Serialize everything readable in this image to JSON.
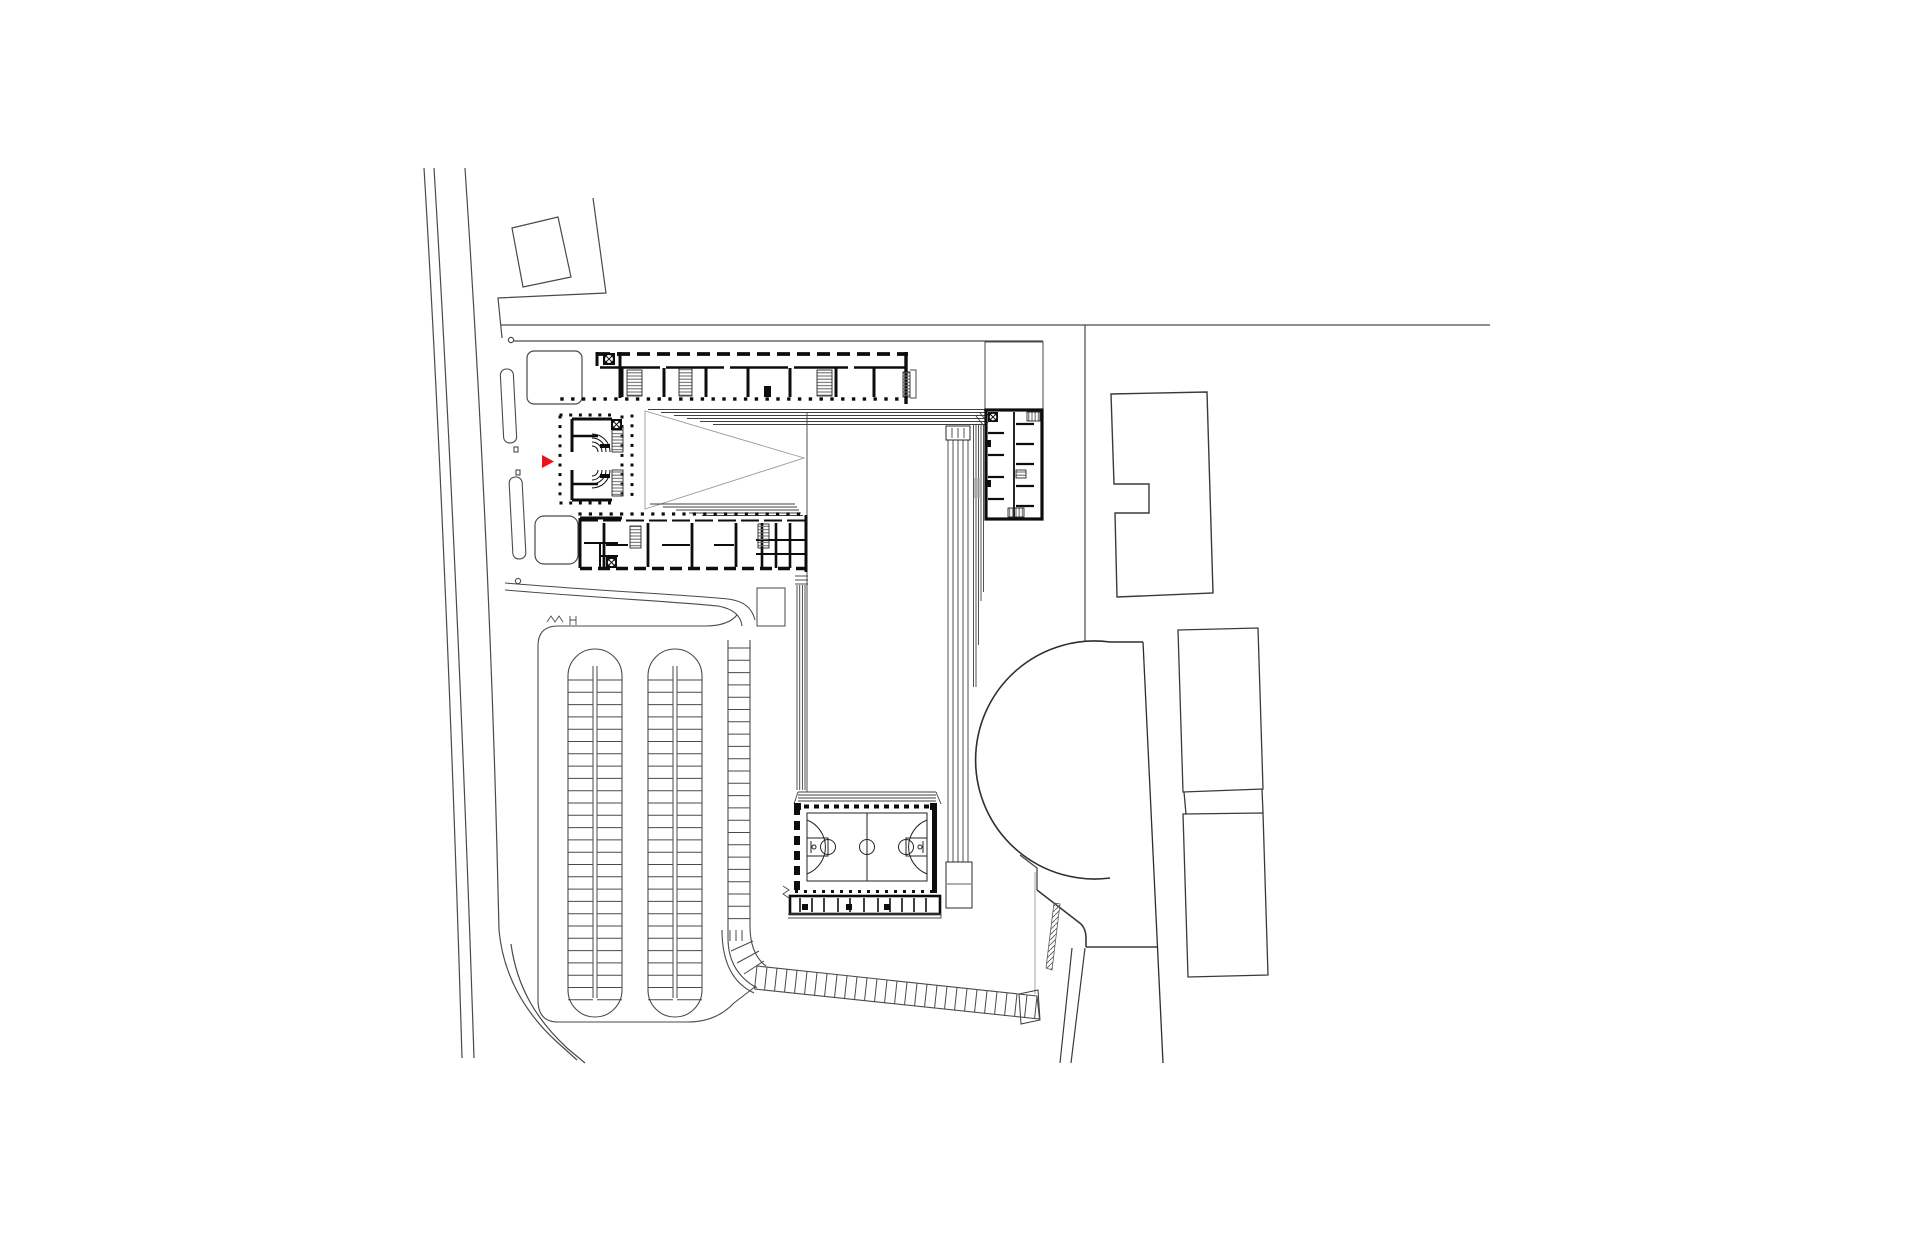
{
  "meta": {
    "kind": "architectural-site-plan",
    "canvas": {
      "width": 1920,
      "height": 1260,
      "background": "#ffffff"
    }
  },
  "colors": {
    "ink": "#0d0d0d",
    "site": "#4a4a4a",
    "roof": "#3f3f3f",
    "light": "#9a9a9a",
    "hatch": "#6f6f6f",
    "red": "#e8131b",
    "grey_fill": "#a8a8a8"
  },
  "marker": {
    "shape": "triangle-right",
    "points": [
      [
        542,
        455
      ],
      [
        542,
        468
      ],
      [
        554,
        461.5
      ]
    ],
    "color": "#e8131b"
  },
  "plan": {
    "dot_rows": [
      {
        "y": 399,
        "x1": 562,
        "x2": 904,
        "step": 10.8,
        "s": 3.4
      },
      {
        "y": 415,
        "x1": 561,
        "x2": 619,
        "step": 9.7,
        "s": 3
      },
      {
        "y": 503,
        "x1": 561,
        "x2": 619,
        "step": 9.7,
        "s": 3
      },
      {
        "y": 514,
        "x1": 580,
        "x2": 804,
        "step": 10.4,
        "s": 3.2
      }
    ],
    "dot_cols": [
      {
        "x": 560,
        "y1": 417,
        "y2": 501,
        "step": 9.6,
        "s": 3
      },
      {
        "x": 622,
        "y1": 417,
        "y2": 501,
        "step": 9.6,
        "s": 3
      },
      {
        "x": 632,
        "y1": 416,
        "y2": 502,
        "step": 9.8,
        "s": 3
      }
    ],
    "lines": [
      {
        "x1": 622,
        "y1": 368,
        "x2": 622,
        "y2": 397,
        "w": 3,
        "c": "ink"
      },
      {
        "x1": 664,
        "y1": 368,
        "x2": 664,
        "y2": 397,
        "w": 3,
        "c": "ink"
      },
      {
        "x1": 706,
        "y1": 368,
        "x2": 706,
        "y2": 397,
        "w": 3,
        "c": "ink"
      },
      {
        "x1": 748,
        "y1": 368,
        "x2": 748,
        "y2": 397,
        "w": 3,
        "c": "ink"
      },
      {
        "x1": 790,
        "y1": 368,
        "x2": 790,
        "y2": 397,
        "w": 3,
        "c": "ink"
      },
      {
        "x1": 836,
        "y1": 368,
        "x2": 836,
        "y2": 397,
        "w": 3,
        "c": "ink"
      },
      {
        "x1": 874,
        "y1": 368,
        "x2": 874,
        "y2": 397,
        "w": 3,
        "c": "ink"
      },
      {
        "x1": 600,
        "y1": 367.5,
        "x2": 660,
        "y2": 367.5,
        "w": 2.4,
        "c": "ink"
      },
      {
        "x1": 666,
        "y1": 367.5,
        "x2": 724,
        "y2": 367.5,
        "w": 2.4,
        "c": "ink"
      },
      {
        "x1": 730,
        "y1": 367.5,
        "x2": 788,
        "y2": 367.5,
        "w": 2.4,
        "c": "ink"
      },
      {
        "x1": 794,
        "y1": 367.5,
        "x2": 848,
        "y2": 367.5,
        "w": 2.4,
        "c": "ink"
      },
      {
        "x1": 854,
        "y1": 367.5,
        "x2": 906,
        "y2": 367.5,
        "w": 2.4,
        "c": "ink"
      },
      {
        "x1": 906,
        "y1": 352,
        "x2": 906,
        "y2": 404,
        "w": 3.4,
        "c": "ink"
      },
      {
        "x1": 620,
        "y1": 352,
        "x2": 620,
        "y2": 398,
        "w": 3,
        "c": "ink"
      },
      {
        "x1": 597,
        "y1": 352,
        "x2": 597,
        "y2": 366,
        "w": 3,
        "c": "ink"
      },
      {
        "x1": 604,
        "y1": 523,
        "x2": 604,
        "y2": 567,
        "w": 2.8,
        "c": "ink"
      },
      {
        "x1": 648,
        "y1": 523,
        "x2": 648,
        "y2": 567,
        "w": 2.8,
        "c": "ink"
      },
      {
        "x1": 692,
        "y1": 523,
        "x2": 692,
        "y2": 567,
        "w": 2.8,
        "c": "ink"
      },
      {
        "x1": 736,
        "y1": 523,
        "x2": 736,
        "y2": 567,
        "w": 2.8,
        "c": "ink"
      },
      {
        "x1": 762,
        "y1": 523,
        "x2": 762,
        "y2": 568,
        "w": 2.6,
        "c": "ink"
      },
      {
        "x1": 776,
        "y1": 523,
        "x2": 776,
        "y2": 568,
        "w": 2.6,
        "c": "ink"
      },
      {
        "x1": 790,
        "y1": 523,
        "x2": 790,
        "y2": 568,
        "w": 2.6,
        "c": "ink"
      },
      {
        "x1": 606,
        "y1": 545,
        "x2": 628,
        "y2": 545,
        "w": 2,
        "c": "ink"
      },
      {
        "x1": 662,
        "y1": 545,
        "x2": 690,
        "y2": 545,
        "w": 2,
        "c": "ink"
      },
      {
        "x1": 714,
        "y1": 545,
        "x2": 734,
        "y2": 545,
        "w": 2,
        "c": "ink"
      },
      {
        "x1": 756,
        "y1": 540,
        "x2": 806,
        "y2": 540,
        "w": 2,
        "c": "ink"
      },
      {
        "x1": 756,
        "y1": 554,
        "x2": 806,
        "y2": 554,
        "w": 2,
        "c": "ink"
      },
      {
        "x1": 580,
        "y1": 518,
        "x2": 622,
        "y2": 518,
        "w": 3,
        "c": "ink"
      },
      {
        "x1": 580,
        "y1": 518,
        "x2": 580,
        "y2": 568,
        "w": 3,
        "c": "ink"
      },
      {
        "x1": 806,
        "y1": 515,
        "x2": 806,
        "y2": 572,
        "w": 3,
        "c": "ink"
      },
      {
        "x1": 584,
        "y1": 543,
        "x2": 618,
        "y2": 543,
        "w": 2,
        "c": "ink"
      },
      {
        "x1": 600,
        "y1": 543,
        "x2": 600,
        "y2": 567,
        "w": 2,
        "c": "ink"
      },
      {
        "x1": 600,
        "y1": 556,
        "x2": 618,
        "y2": 556,
        "w": 2,
        "c": "ink"
      },
      {
        "x1": 1014,
        "y1": 412,
        "x2": 1014,
        "y2": 517,
        "w": 1.8,
        "c": "ink"
      },
      {
        "x1": 988,
        "y1": 433,
        "x2": 1004,
        "y2": 433,
        "w": 2.2,
        "c": "ink"
      },
      {
        "x1": 988,
        "y1": 455,
        "x2": 1004,
        "y2": 455,
        "w": 2.2,
        "c": "ink"
      },
      {
        "x1": 988,
        "y1": 477,
        "x2": 1004,
        "y2": 477,
        "w": 2.2,
        "c": "ink"
      },
      {
        "x1": 988,
        "y1": 499,
        "x2": 1004,
        "y2": 499,
        "w": 2.2,
        "c": "ink"
      },
      {
        "x1": 1016,
        "y1": 424,
        "x2": 1034,
        "y2": 424,
        "w": 2.2,
        "c": "ink"
      },
      {
        "x1": 1016,
        "y1": 444,
        "x2": 1034,
        "y2": 444,
        "w": 2.2,
        "c": "ink"
      },
      {
        "x1": 1016,
        "y1": 464,
        "x2": 1034,
        "y2": 464,
        "w": 2.2,
        "c": "ink"
      },
      {
        "x1": 1016,
        "y1": 486,
        "x2": 1034,
        "y2": 486,
        "w": 2.2,
        "c": "ink"
      },
      {
        "x1": 1016,
        "y1": 506,
        "x2": 1034,
        "y2": 506,
        "w": 2.2,
        "c": "ink"
      }
    ],
    "bleacher_top": [
      {
        "y": 409.5,
        "x1": 648,
        "x2": 986
      },
      {
        "y": 412.5,
        "x1": 661,
        "x2": 986
      },
      {
        "y": 415.5,
        "x1": 674,
        "x2": 986
      },
      {
        "y": 418.5,
        "x1": 687,
        "x2": 986
      },
      {
        "y": 421.5,
        "x1": 700,
        "x2": 986
      },
      {
        "y": 424.5,
        "x1": 713,
        "x2": 986
      }
    ],
    "bleacher_bottom": [
      {
        "y": 504,
        "x1": 650,
        "x2": 795
      },
      {
        "y": 507,
        "x1": 663,
        "x2": 797
      },
      {
        "y": 510,
        "x1": 676,
        "x2": 799
      },
      {
        "y": 513,
        "x1": 689,
        "x2": 801
      },
      {
        "y": 515.5,
        "x1": 702,
        "x2": 803
      }
    ],
    "roof_band_right": [
      {
        "x": 973.5,
        "y1": 424,
        "y2": 687
      },
      {
        "x": 976,
        "y1": 424,
        "y2": 687
      },
      {
        "x": 978.5,
        "y1": 424,
        "y2": 645
      },
      {
        "x": 981,
        "y1": 424,
        "y2": 601
      },
      {
        "x": 983.5,
        "y1": 424,
        "y2": 592
      },
      {
        "x": 986,
        "y1": 412,
        "y2": 500
      }
    ],
    "ramp_lines": [
      {
        "x": 948,
        "y1": 440,
        "y2": 862
      },
      {
        "x": 953,
        "y1": 440,
        "y2": 862
      },
      {
        "x": 958,
        "y1": 440,
        "y2": 862
      },
      {
        "x": 963,
        "y1": 440,
        "y2": 862
      },
      {
        "x": 968,
        "y1": 440,
        "y2": 862
      }
    ],
    "hall_left_band": [
      {
        "x": 807,
        "y1": 412,
        "y2": 792
      },
      {
        "x": 797,
        "y1": 585,
        "y2": 790
      },
      {
        "x": 799.7,
        "y1": 585,
        "y2": 790
      },
      {
        "x": 802.4,
        "y1": 585,
        "y2": 790
      },
      {
        "x": 805,
        "y1": 585,
        "y2": 790
      }
    ],
    "hall_corner_steps": [
      {
        "y": 576,
        "x1": 795,
        "x2": 808
      },
      {
        "y": 580,
        "x1": 795,
        "x2": 808
      },
      {
        "y": 584,
        "x1": 795,
        "x2": 808
      }
    ],
    "court_roof_band": [
      {
        "y": 792,
        "x1": 798,
        "x2": 936
      },
      {
        "y": 795,
        "x1": 798,
        "x2": 936
      },
      {
        "y": 798,
        "x1": 798,
        "x2": 936
      },
      {
        "y": 801,
        "x1": 798,
        "x2": 936
      }
    ],
    "strip_dividers": [
      800,
      812,
      824,
      838,
      850,
      864,
      878,
      890,
      902,
      914,
      926
    ],
    "strip_divider_y": {
      "y1": 898,
      "y2": 912
    },
    "hatch_rects": [
      {
        "x": 627,
        "y": 370,
        "w": 15,
        "h": 26,
        "p": "H"
      },
      {
        "x": 817,
        "y": 370,
        "w": 15,
        "h": 26,
        "p": "H"
      },
      {
        "x": 679,
        "y": 368,
        "w": 13,
        "h": 28,
        "p": "H"
      },
      {
        "x": 612,
        "y": 426,
        "w": 11,
        "h": 26,
        "p": "H"
      },
      {
        "x": 612,
        "y": 470,
        "w": 11,
        "h": 26,
        "p": "H"
      },
      {
        "x": 630,
        "y": 526,
        "w": 11,
        "h": 22,
        "p": "H"
      },
      {
        "x": 758,
        "y": 524,
        "w": 11,
        "h": 24,
        "p": "H"
      },
      {
        "x": 1027,
        "y": 412,
        "w": 13,
        "h": 9,
        "p": "V"
      },
      {
        "x": 1008,
        "y": 508,
        "w": 16,
        "h": 9,
        "p": "V"
      },
      {
        "x": 903,
        "y": 372,
        "w": 7,
        "h": 25,
        "p": "H"
      },
      {
        "x": 1016,
        "y": 470,
        "w": 10,
        "h": 8,
        "p": "H"
      }
    ],
    "column_symbols": [
      {
        "x": 603,
        "y": 353,
        "s": 12
      },
      {
        "x": 611,
        "y": 419,
        "s": 11
      },
      {
        "x": 606,
        "y": 557,
        "s": 11
      },
      {
        "x": 988,
        "y": 412,
        "s": 10
      }
    ],
    "parking": {
      "rung_step": 12.3,
      "pairs": [
        {
          "x1": 568,
          "x2": 622,
          "mid": [
            593,
            597
          ],
          "ytop": 676,
          "ybot": 990,
          "ry1": 680,
          "ry2": 1002
        },
        {
          "x1": 648,
          "x2": 702,
          "mid": [
            673,
            677
          ],
          "ytop": 676,
          "ybot": 990,
          "ry1": 680,
          "ry2": 1002
        }
      ],
      "right_ladder": {
        "rails": [
          728,
          750
        ],
        "ry1": 648,
        "ry2": 924
      },
      "curve_rungs": [
        [
          731,
          951,
          753,
          941
        ],
        [
          737,
          963,
          759,
          951
        ],
        [
          744,
          974,
          764,
          961
        ]
      ],
      "entry_steps": [
        [
          730,
          930,
          730,
          941
        ],
        [
          736,
          930,
          736,
          941
        ],
        [
          742,
          930,
          742,
          941
        ]
      ]
    },
    "walkway": {
      "x1": 757,
      "y1": 966,
      "x2": 1037,
      "y2": 996,
      "h": 23,
      "rungs": 29
    },
    "black_bits": [
      {
        "x": 764,
        "y": 386,
        "w": 7,
        "h": 11
      },
      {
        "x": 600,
        "y": 444,
        "w": 10,
        "h": 4
      },
      {
        "x": 600,
        "y": 474,
        "w": 10,
        "h": 4
      },
      {
        "x": 986,
        "y": 440,
        "w": 5,
        "h": 7
      },
      {
        "x": 986,
        "y": 480,
        "w": 5,
        "h": 7
      },
      {
        "x": 802,
        "y": 904,
        "w": 6,
        "h": 6
      },
      {
        "x": 846,
        "y": 904,
        "w": 6,
        "h": 6
      },
      {
        "x": 884,
        "y": 904,
        "w": 6,
        "h": 6
      },
      {
        "x": 794,
        "y": 803,
        "w": 7,
        "h": 7
      },
      {
        "x": 930,
        "y": 803,
        "w": 7,
        "h": 7
      }
    ]
  }
}
